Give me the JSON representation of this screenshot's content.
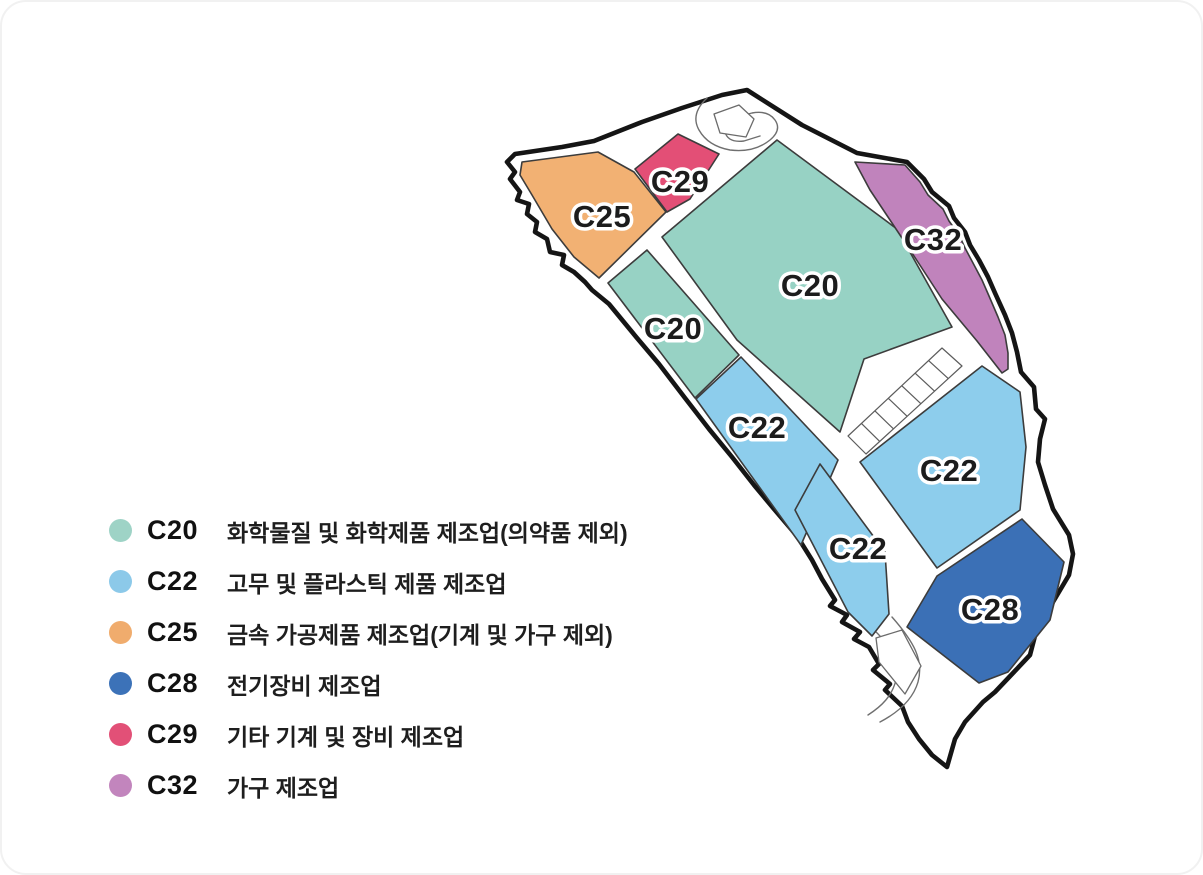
{
  "legend": {
    "items": [
      {
        "code": "C20",
        "color": "#9ed3c6",
        "label": "화학물질 및 화학제품 제조업(의약품 제외)"
      },
      {
        "code": "C22",
        "color": "#8cc9e9",
        "label": "고무 및 플라스틱 제품 제조업"
      },
      {
        "code": "C25",
        "color": "#f0ac6d",
        "label": "금속 가공제품 제조업(기계 및 가구 제외)"
      },
      {
        "code": "C28",
        "color": "#3c72b8",
        "label": "전기장비 제조업"
      },
      {
        "code": "C29",
        "color": "#e25077",
        "label": "기타 기계 및 장비 제조업"
      },
      {
        "code": "C32",
        "color": "#c285bd",
        "label": "가구 제조업"
      }
    ]
  },
  "map": {
    "boundary": {
      "points": "745,88 800,123 855,151 905,160 922,177 930,190 947,204 952,216 963,230 968,243 977,258 986,275 993,291 1003,313 1010,331 1015,350 1019,370 1032,385 1034,407 1043,417 1038,437 1036,460 1043,483 1051,507 1067,533 1071,552 1067,573 1051,600 1034,630 1028,653 1012,670 993,690 981,700 963,720 953,737 945,765 930,753 917,737 906,720 900,704 883,688 888,682 871,668 877,662 867,645 852,637 858,630 840,620 845,613 828,604 833,598 820,577 810,558 795,534 772,507 752,483 730,455 707,427 683,396 657,362 635,336 607,302 590,288 583,280 572,270 560,263 562,253 548,250 545,237 533,230 535,220 525,212 527,202 515,198 518,190 508,177 513,170 505,160 513,152 560,145 592,139 640,120 680,106 720,93",
      "fill": "#ffffff",
      "stroke": "#151515"
    },
    "parcels": [
      {
        "id": "c25",
        "code": "C25",
        "fill": "#f2b173",
        "points": "520,160 596,150 632,170 664,210 597,276 572,255 550,227 530,193 518,173",
        "label_x": 600,
        "label_y": 225
      },
      {
        "id": "c29",
        "code": "C29",
        "fill": "#e34f76",
        "points": "633,167 676,132 717,152 688,197 665,210",
        "label_x": 678,
        "label_y": 190
      },
      {
        "id": "c20-small",
        "code": "C20",
        "fill": "#97d2c4",
        "points": "645,248 737,353 693,396 606,281",
        "label_x": 671,
        "label_y": 337
      },
      {
        "id": "c20-large",
        "code": "C20",
        "fill": "#97d2c4",
        "points": "775,138 895,227 950,325 862,357 838,430 735,338 660,235",
        "label_x": 808,
        "label_y": 294
      },
      {
        "id": "c32",
        "code": "C32",
        "fill": "#c083bc",
        "points": "853,160 903,163 918,180 926,193 941,207 947,219 957,233 963,246 971,261 980,278 987,294 996,315 1003,333 1006,351 1006,367 1000,371 975,339 940,297 912,254 888,218 868,188",
        "label_x": 931,
        "label_y": 248
      },
      {
        "id": "c22-upper",
        "code": "C22",
        "fill": "#8dcdec",
        "points": "694,397 739,355 836,458 799,543",
        "label_x": 755,
        "label_y": 436
      },
      {
        "id": "c22-large",
        "code": "C22",
        "fill": "#8dcdec",
        "points": "980,364 1018,390 1024,445 1018,508 935,566 858,460",
        "label_x": 947,
        "label_y": 479
      },
      {
        "id": "c22-mid",
        "code": "C22",
        "fill": "#8dcdec",
        "points": "818,462 883,550 887,612 870,634 846,610 793,508",
        "label_x": 856,
        "label_y": 557
      },
      {
        "id": "c28",
        "code": "C28",
        "fill": "#3b70b6",
        "points": "1020,517 1062,560 1048,618 1006,670 977,681 905,625 935,574",
        "label_x": 988,
        "label_y": 618
      }
    ],
    "strip": {
      "points": "846,434 940,346 960,364 864,452",
      "cells": 7
    },
    "empty_parcels": [
      {
        "id": "loop-island",
        "points": "712,112 737,103 752,117 744,135 718,131"
      },
      {
        "id": "bottom-parcel",
        "points": "874,636 900,628 919,664 903,692 877,660"
      }
    ],
    "roads": [
      {
        "id": "loop-road",
        "d": "M705,96 Q688,112 697,128 Q706,144 728,148 Q752,151 768,138 Q780,128 773,118 Q766,108 750,111 L734,115 Q720,119 723,130 Q726,141 742,139 L758,134"
      },
      {
        "id": "bottom-road-outer",
        "d": "M890,615 C912,640 922,658 916,680 C911,697 897,710 878,720"
      },
      {
        "id": "bottom-road-inner",
        "d": "M872,628 C890,645 898,661 894,678 C890,694 880,704 866,713"
      }
    ]
  }
}
